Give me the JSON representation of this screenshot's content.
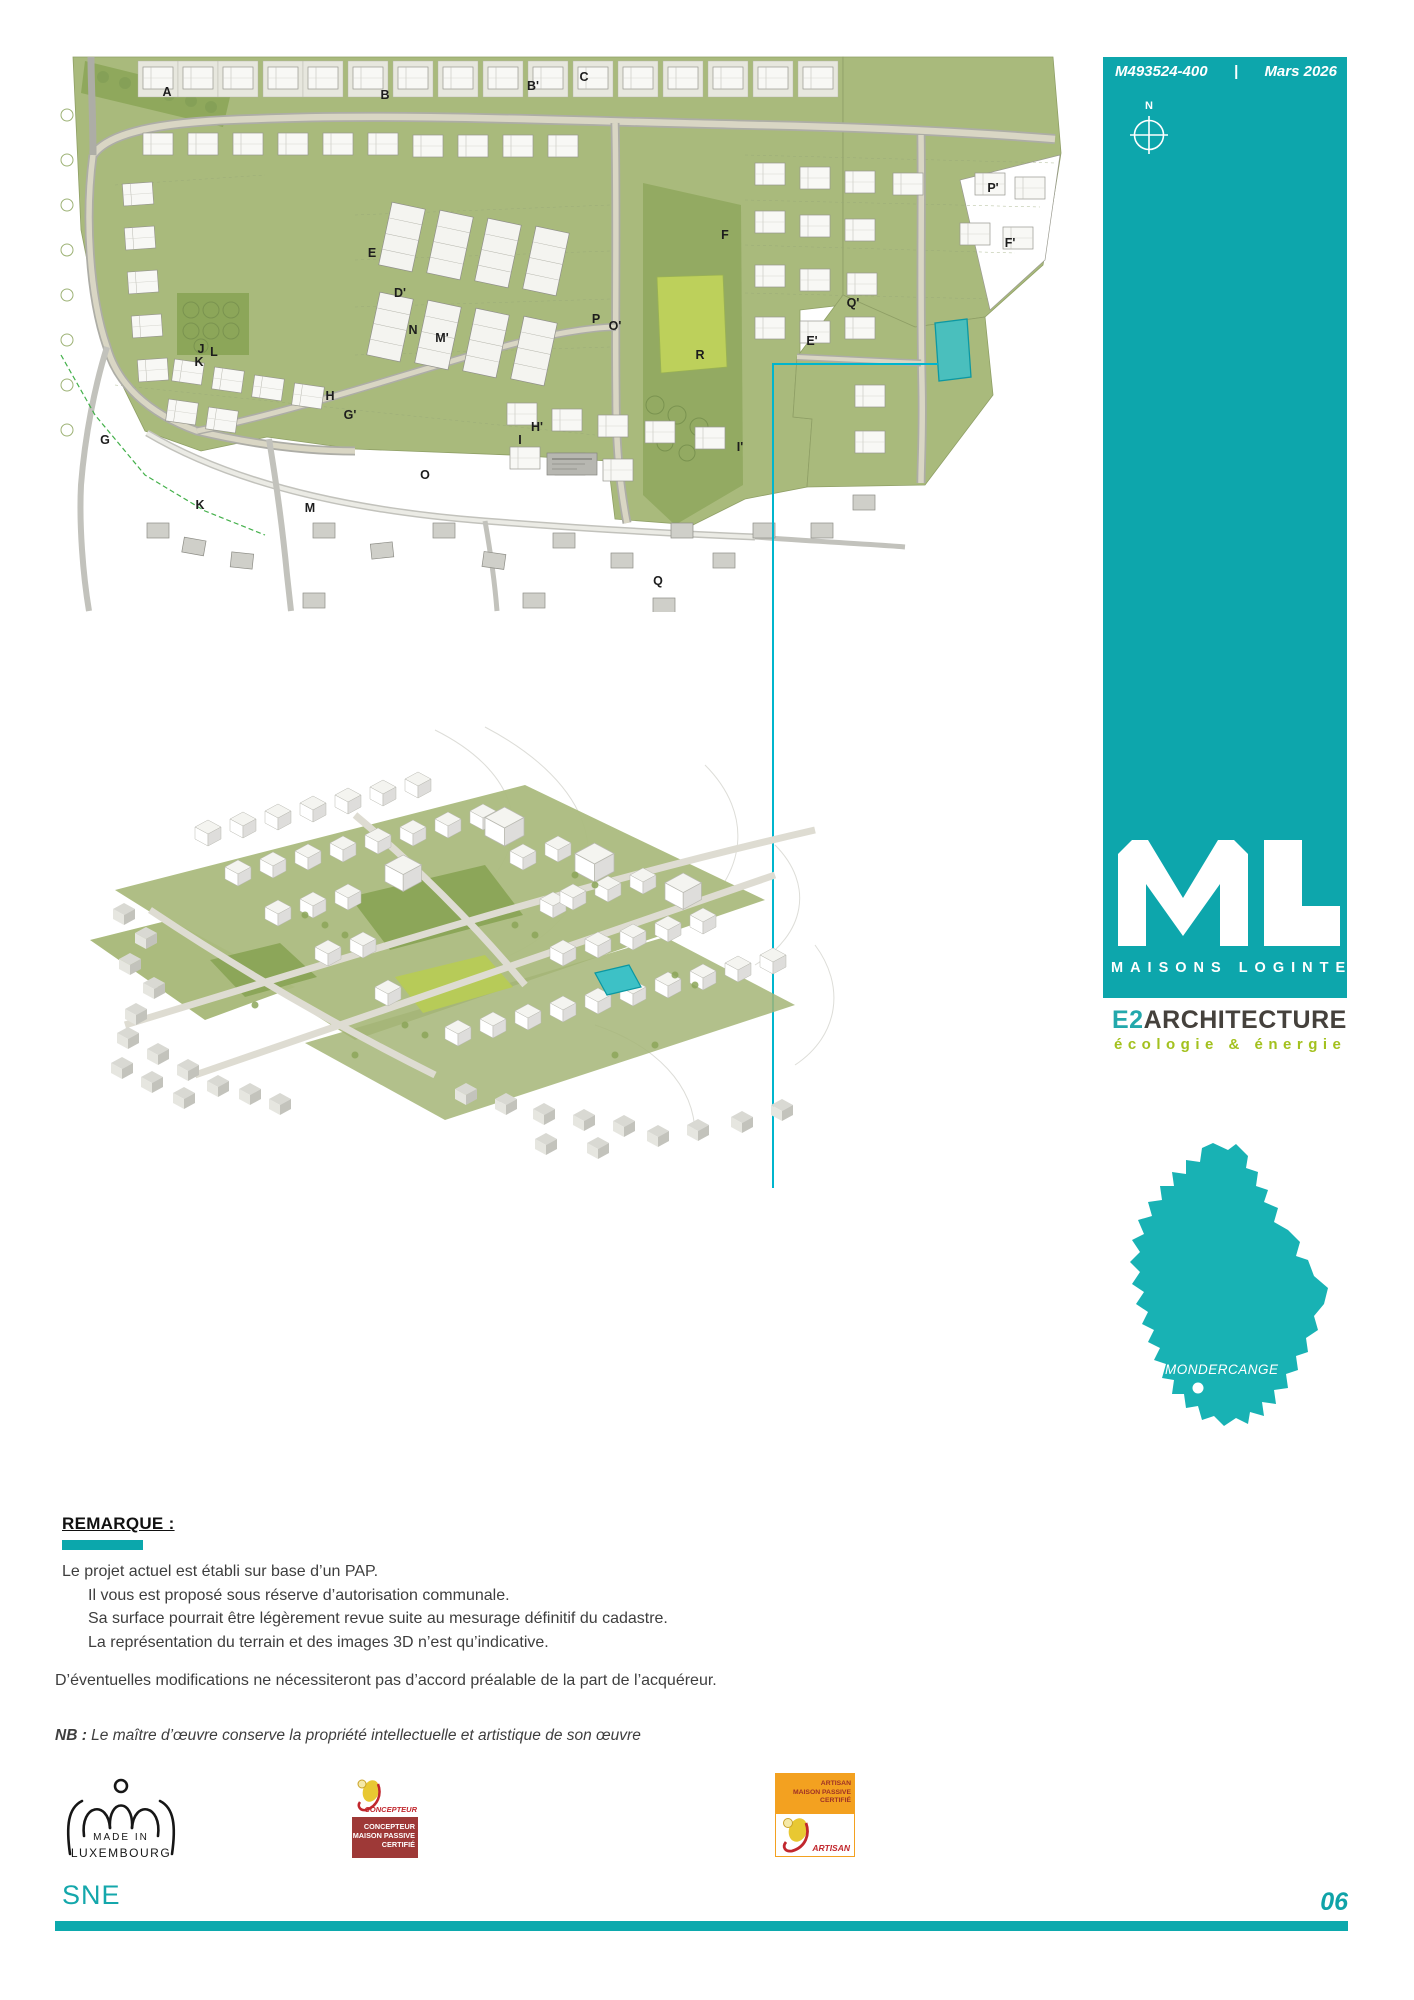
{
  "header": {
    "ref": "M493524-400",
    "sep": "|",
    "date": "Mars 2026",
    "compass_n": "N"
  },
  "brand": {
    "name": "MAISONS LOGINTER",
    "arch_prefix": "E2",
    "arch_rest": "ARCHITECTURE",
    "tagline": "écologie & énergie",
    "location": "MONDERCANGE"
  },
  "colors": {
    "teal": "#0da6ac",
    "cyan_callout": "#00b5cd",
    "lime": "#a3c11e",
    "plan_green": "#a9ba7c",
    "park_bright": "#bdd05b",
    "park_dark": "#8ca659"
  },
  "site_plan": {
    "labels": [
      {
        "t": "A",
        "x": 112,
        "y": 37
      },
      {
        "t": "B",
        "x": 330,
        "y": 40
      },
      {
        "t": "B'",
        "x": 478,
        "y": 31
      },
      {
        "t": "C",
        "x": 529,
        "y": 22
      },
      {
        "t": "E",
        "x": 317,
        "y": 198
      },
      {
        "t": "D'",
        "x": 345,
        "y": 238
      },
      {
        "t": "N",
        "x": 358,
        "y": 275
      },
      {
        "t": "M'",
        "x": 387,
        "y": 283
      },
      {
        "t": "J",
        "x": 146,
        "y": 294
      },
      {
        "t": "L",
        "x": 159,
        "y": 297
      },
      {
        "t": "K",
        "x": 144,
        "y": 307
      },
      {
        "t": "F",
        "x": 670,
        "y": 180
      },
      {
        "t": "P",
        "x": 541,
        "y": 264
      },
      {
        "t": "O'",
        "x": 560,
        "y": 271
      },
      {
        "t": "Q'",
        "x": 798,
        "y": 248
      },
      {
        "t": "E'",
        "x": 757,
        "y": 286
      },
      {
        "t": "R",
        "x": 645,
        "y": 300
      },
      {
        "t": "F'",
        "x": 955,
        "y": 188
      },
      {
        "t": "P'",
        "x": 938,
        "y": 133
      },
      {
        "t": "G",
        "x": 50,
        "y": 385
      },
      {
        "t": "H",
        "x": 275,
        "y": 341
      },
      {
        "t": "G'",
        "x": 295,
        "y": 360
      },
      {
        "t": "H'",
        "x": 482,
        "y": 372
      },
      {
        "t": "I",
        "x": 465,
        "y": 385
      },
      {
        "t": "I'",
        "x": 685,
        "y": 392
      },
      {
        "t": "O",
        "x": 370,
        "y": 420
      },
      {
        "t": "K",
        "x": 145,
        "y": 450
      },
      {
        "t": "M",
        "x": 255,
        "y": 453
      },
      {
        "t": "Q",
        "x": 603,
        "y": 526
      }
    ]
  },
  "remark": {
    "title": "REMARQUE :",
    "lines": [
      "Le projet actuel est établi sur base d’un PAP.",
      "Il vous est proposé sous réserve d’autorisation communale.",
      "Sa surface pourrait être légèrement revue suite au mesurage définitif du cadastre.",
      "La représentation du terrain et des images  3D n’est qu’indicative."
    ],
    "paragraph2": "D’éventuelles modifications ne nécessiteront pas d’accord préalable de la part de l’acquéreur.",
    "nb_label": "NB :",
    "nb_text": "Le maître d’œuvre conserve la propriété intellectuelle et artistique de son œuvre"
  },
  "logos": {
    "made_in": {
      "line1": "MADE IN",
      "line2": "LUXEMBOURG"
    },
    "concepteur": {
      "top_label": "CONCEPTEUR",
      "lines": [
        "CONCEPTEUR",
        "MAISON PASSIVE",
        "CERTIFIÉ"
      ]
    },
    "artisan": {
      "lines": [
        "ARTISAN",
        "MAISON PASSIVE",
        "CERTIFIÉ"
      ],
      "bottom_label": "ARTISAN"
    }
  },
  "footer": {
    "project": "SNE",
    "page_number": "06"
  }
}
